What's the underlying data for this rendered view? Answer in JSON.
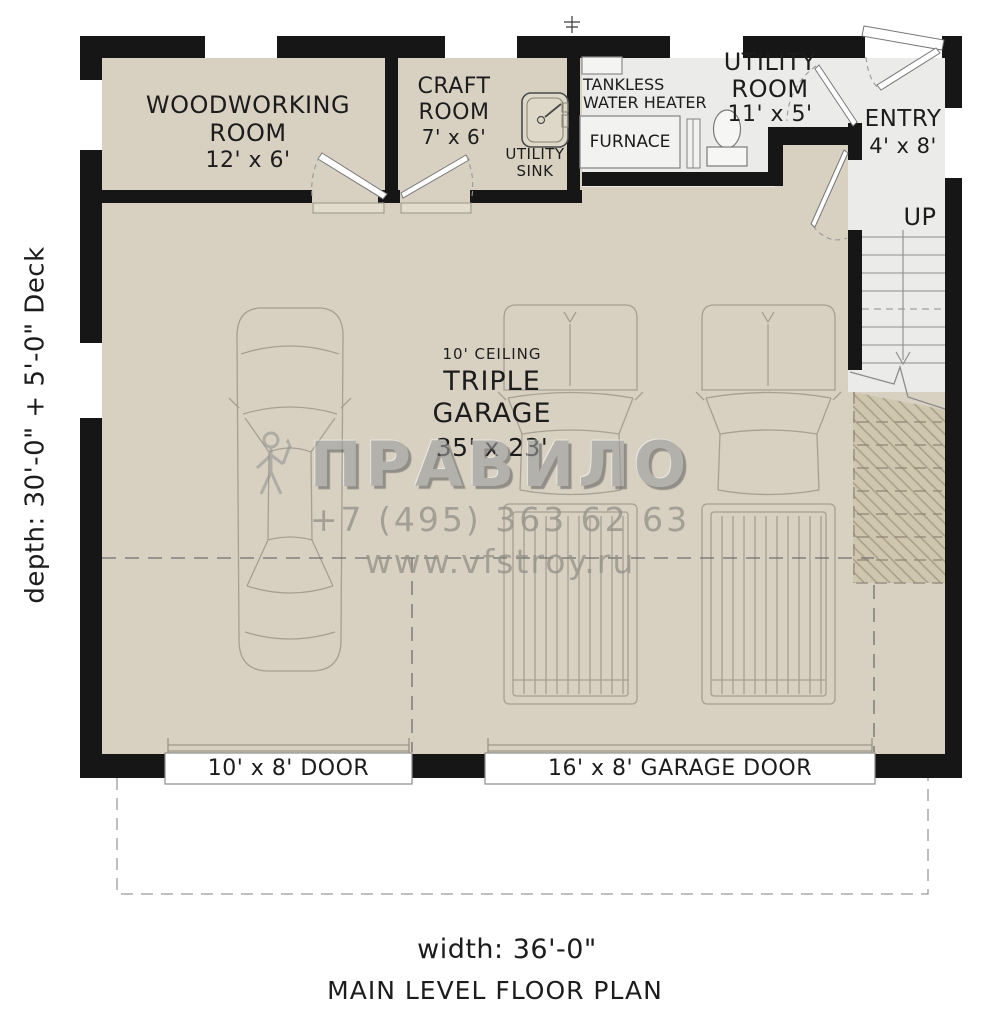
{
  "title": "MAIN LEVEL FLOOR PLAN",
  "dimensions": {
    "width": "width: 36'-0\"",
    "depth": "depth: 30'-0\" + 5'-0\" Deck"
  },
  "rooms": {
    "woodworking": {
      "line1": "WOODWORKING",
      "line2": "ROOM",
      "dims": "12' x 6'"
    },
    "craft": {
      "line1": "CRAFT",
      "line2": "ROOM",
      "dims": "7' x 6'"
    },
    "garage": {
      "ceiling": "10' CEILING",
      "name": "TRIPLE GARAGE",
      "dims": "35' x 23'"
    },
    "utility": {
      "line1": "UTILITY",
      "line2": "ROOM",
      "dims": "11' x 5'"
    },
    "entry": {
      "name": "ENTRY",
      "dims": "4' x 8'"
    }
  },
  "fixtures": {
    "utility_sink": {
      "line1": "UTILITY",
      "line2": "SINK"
    },
    "tankless": {
      "line1": "TANKLESS",
      "line2": "WATER HEATER"
    },
    "furnace": "FURNACE",
    "stairs": {
      "up": "UP"
    }
  },
  "doors": {
    "left_door": "10' x 8' DOOR",
    "garage_door": "16' x 8' GARAGE DOOR"
  },
  "watermark": {
    "brand_left": "ПРАВ",
    "brand_right": "ИЛО",
    "phone": "+7 (495) 363 62 63",
    "site": "www.vfstroy.ru"
  },
  "colors": {
    "floor_beige": "#d8d1c2",
    "room_gray": "#ebebe9",
    "wall_black": "#161616",
    "line_gray": "#a69f92",
    "hatch_fill": "#cfc6b0",
    "hatch_line": "#a89d85"
  }
}
